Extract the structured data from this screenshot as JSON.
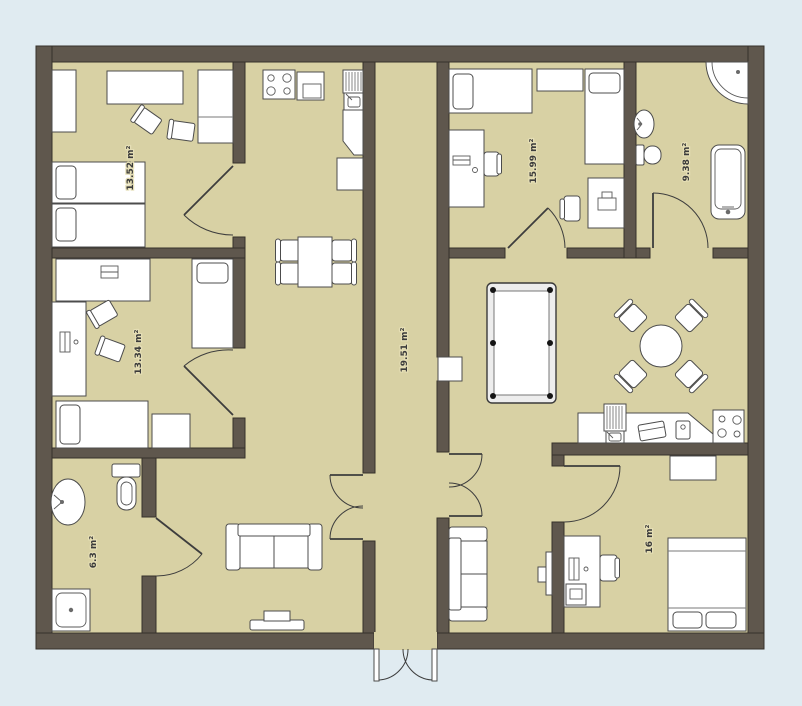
{
  "plan_title": "apartment-floor-plan",
  "colors": {
    "background": "#e0ebf1",
    "floor": "#d8d1a4",
    "walls": "#5f574d",
    "furniture_fill": "#ffffff",
    "furniture_stroke": "#4c4c4c",
    "label_text": "#3b3b3b"
  },
  "rooms": [
    {
      "name": "bedroom-top-left",
      "area_label": "13.52 m²",
      "furniture": [
        "cabinet",
        "desk",
        "chair",
        "chair",
        "wardrobe",
        "single-bed",
        "single-bed",
        "door"
      ]
    },
    {
      "name": "bedroom-middle-left",
      "area_label": "13.34 m²",
      "furniture": [
        "desk",
        "laptop",
        "chair",
        "chair",
        "single-bed",
        "desk-with-computer",
        "single-bed",
        "nightstand",
        "door"
      ]
    },
    {
      "name": "bathroom-bottom-left",
      "area_label": "6.3 m²",
      "furniture": [
        "washbasin",
        "toilet",
        "shower",
        "door"
      ]
    },
    {
      "name": "hallway",
      "area_label": "19.51 m²",
      "furniture": [
        "stove",
        "oven-cabinet",
        "sink-with-drainer",
        "corner-cabinet",
        "cabinet",
        "dining-table",
        "chairs",
        "double-door",
        "double-door",
        "entrance-double-door"
      ]
    },
    {
      "name": "bedroom-top-right",
      "area_label": "15.99 m²",
      "furniture": [
        "single-bed",
        "shelf",
        "single-bed",
        "desk-with-computer",
        "chair",
        "desk-with-laptop",
        "chair",
        "door"
      ]
    },
    {
      "name": "bathroom-top-right",
      "area_label": "9.38 m²",
      "furniture": [
        "corner-shower",
        "washbasin",
        "toilet",
        "bathtub",
        "door"
      ]
    },
    {
      "name": "bedroom-bottom-right",
      "area_label": "16 m²",
      "furniture": [
        "wardrobe",
        "double-bed",
        "desk-with-computer",
        "chair",
        "printer-stand",
        "door"
      ]
    },
    {
      "name": "living-room-left",
      "area_label": "",
      "furniture": [
        "sofa",
        "tv-console",
        "door-to-bathroom"
      ]
    },
    {
      "name": "living-room-right",
      "area_label": "",
      "furniture": [
        "pool-table",
        "round-table",
        "chairs",
        "kitchen-counter",
        "sink-with-drainer",
        "cutting-board",
        "appliance",
        "stove",
        "wall-shelf"
      ]
    },
    {
      "name": "tv-lounge",
      "area_label": "",
      "furniture": [
        "sofa",
        "tv-panel"
      ]
    }
  ]
}
